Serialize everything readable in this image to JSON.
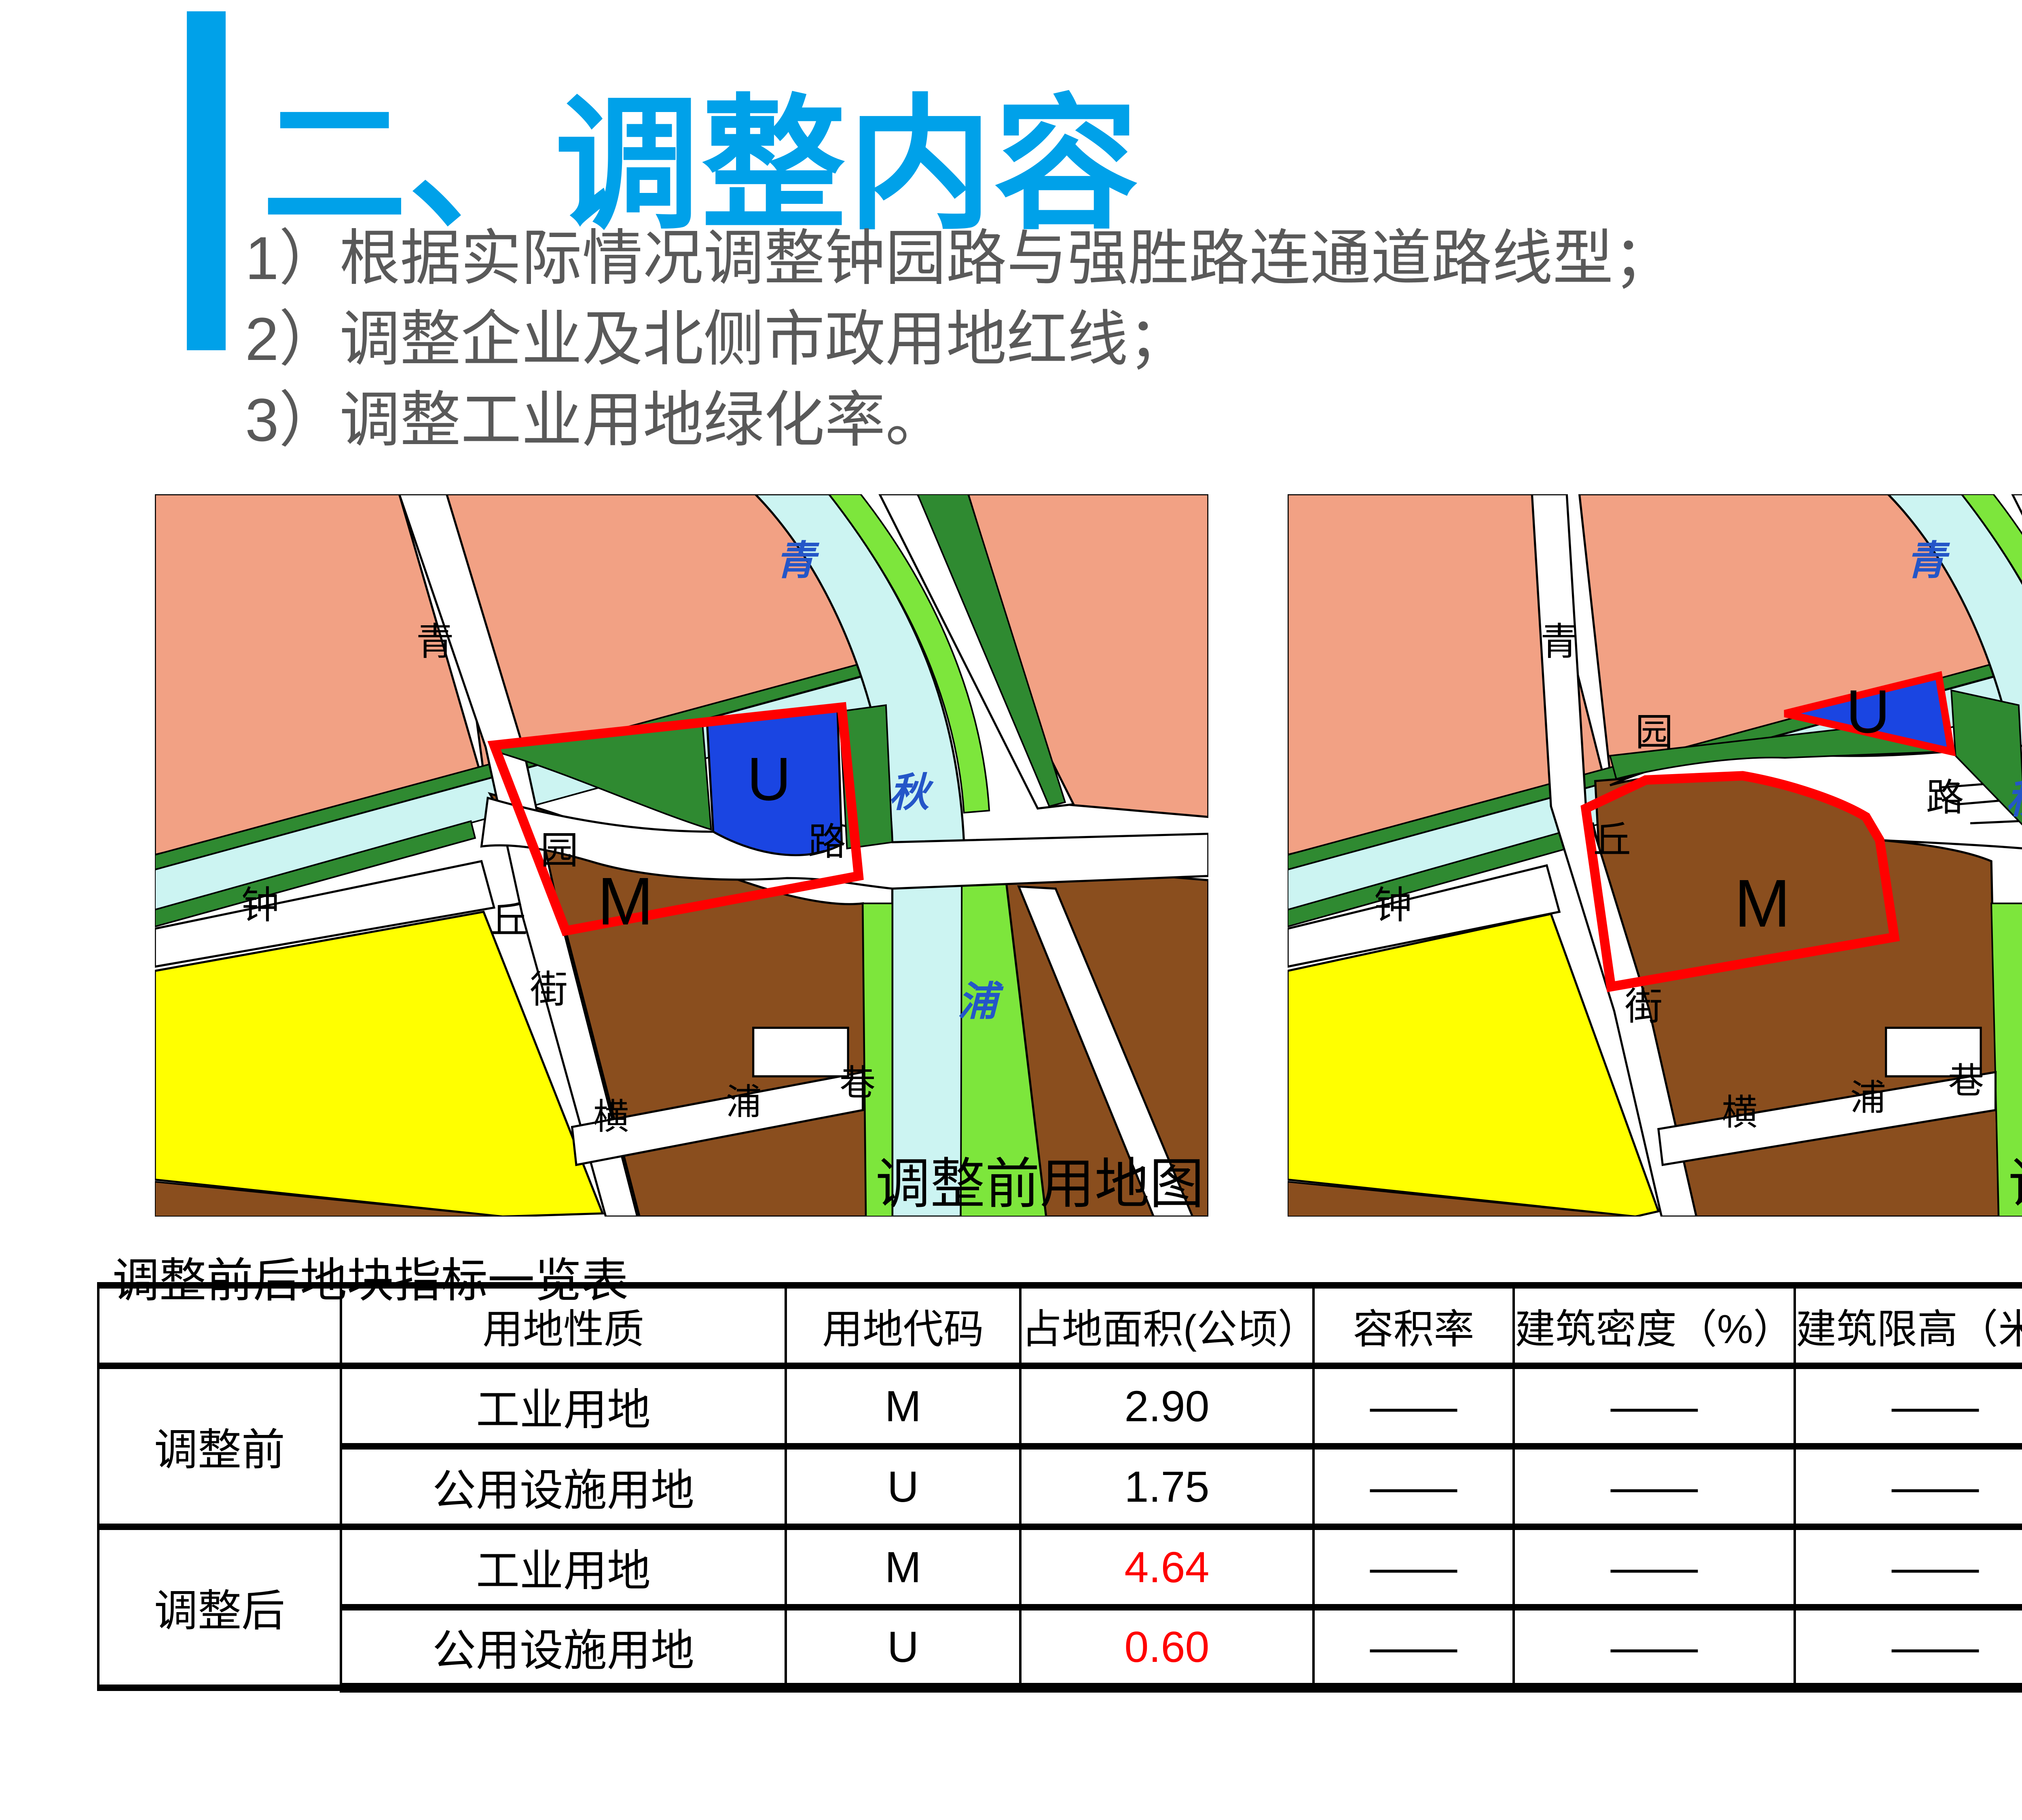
{
  "slide": {
    "title": "二、调整内容",
    "bullets": [
      "1）根据实际情况调整钟园路与强胜路连通道路线型；",
      "2）调整企业及北侧市政用地红线；",
      "3）调整工业用地绿化率。"
    ],
    "accent_color": "#00A1E9",
    "body_text_color": "#595959"
  },
  "maps": {
    "palette": {
      "residential_salmon": "#F2A184",
      "water_cyan": "#CCF4F2",
      "park_dark_green": "#2F8A31",
      "greenbelt_light_green": "#7DE63C",
      "commercial_yellow": "#FFFF00",
      "industrial_brown": "#8A4E1E",
      "utility_blue": "#1A45E2",
      "boundary_red": "#FF0000",
      "road_white": "#FFFFFF",
      "river_label_blue": "#2456C8"
    },
    "before": {
      "caption": "调整前用地图",
      "zone_labels": {
        "m": "M",
        "u": "U"
      },
      "road_labels": {
        "qing": "青",
        "zhong": "钟",
        "yuan": "园",
        "lu": "路",
        "qiu": "丘",
        "jie": "街",
        "heng": "横",
        "pu": "浦",
        "xiang": "巷"
      },
      "river_labels": {
        "qing": "青",
        "qiu": "秋",
        "pu": "浦"
      }
    },
    "after": {
      "caption": "调整后用地图",
      "zone_labels": {
        "m": "M",
        "u": "U"
      },
      "road_labels": {
        "qing": "青",
        "zhong": "钟",
        "yuan": "园",
        "lu": "路",
        "qiu": "丘",
        "jie": "街",
        "heng": "横",
        "pu": "浦",
        "xiang": "巷"
      },
      "river_labels": {
        "qing": "青",
        "qiu": "秋",
        "pu": "浦"
      }
    }
  },
  "table": {
    "title": "调整前后地块指标一览表",
    "headers": [
      "",
      "用地性质",
      "用地代码",
      "占地面积(公顷）",
      "容积率",
      "建筑密度（%）",
      "建筑限高（米）",
      "绿化率（%）"
    ],
    "groups": [
      {
        "label": "调整前"
      },
      {
        "label": "调整后"
      }
    ],
    "rows": [
      {
        "land_use": "工业用地",
        "code": "M",
        "area": "2.90",
        "far": "——",
        "density": "——",
        "height_limit": "——",
        "green_rate": "——"
      },
      {
        "land_use": "公用设施用地",
        "code": "U",
        "area": "1.75",
        "far": "——",
        "density": "——",
        "height_limit": "——",
        "green_rate": "——"
      },
      {
        "land_use": "工业用地",
        "code": "M",
        "area": "4.64",
        "far": "——",
        "density": "——",
        "height_limit": "——",
        "green_rate": "15%"
      },
      {
        "land_use": "公用设施用地",
        "code": "U",
        "area": "0.60",
        "far": "——",
        "density": "——",
        "height_limit": "——",
        "green_rate": "——"
      }
    ],
    "highlight_color": "#FF0000"
  }
}
